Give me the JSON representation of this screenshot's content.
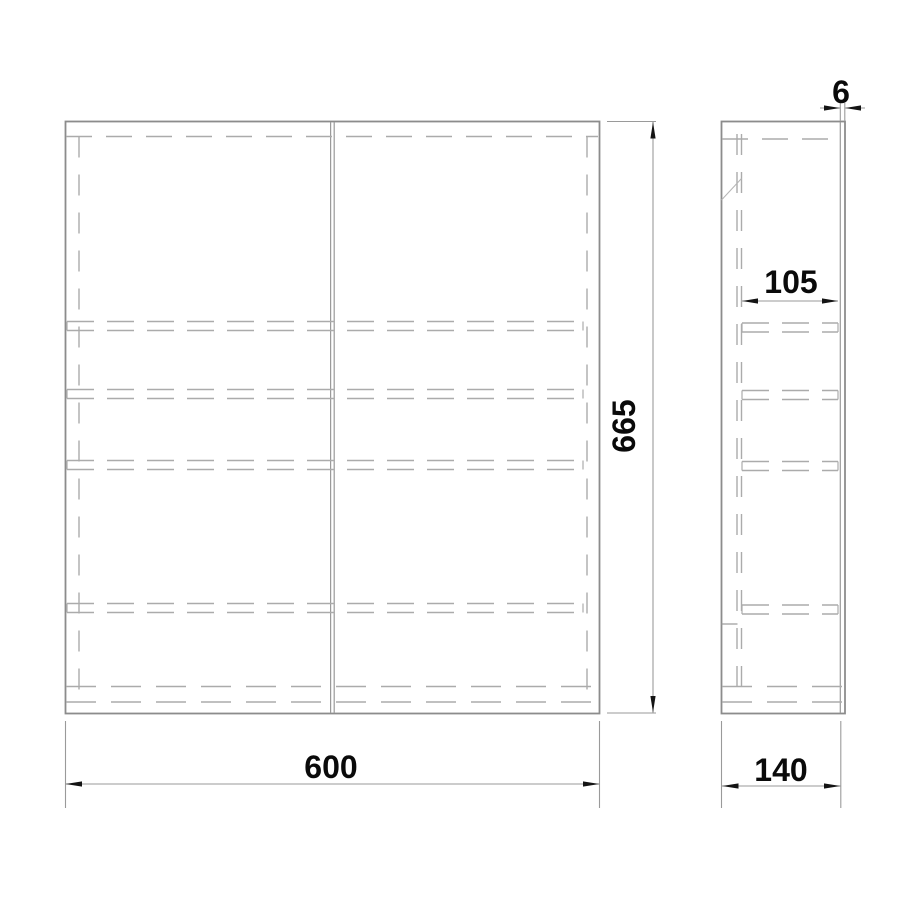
{
  "drawing": {
    "type": "technical-drawing",
    "views": {
      "front_view": {
        "name": "cabinet front view"
      },
      "side_view": {
        "name": "cabinet side view"
      }
    },
    "dimensions": {
      "width_label": "600",
      "height_label": "665",
      "depth_label": "140",
      "inner_depth_label": "105",
      "door_thickness_label": "6"
    },
    "colors": {
      "outline_line": "#8c8c8c",
      "hidden_line": "#ababab",
      "dimension_line": "#9a9a9a",
      "arrow": "#141414",
      "text": "#0a0a0a",
      "background": "#ffffff"
    }
  }
}
